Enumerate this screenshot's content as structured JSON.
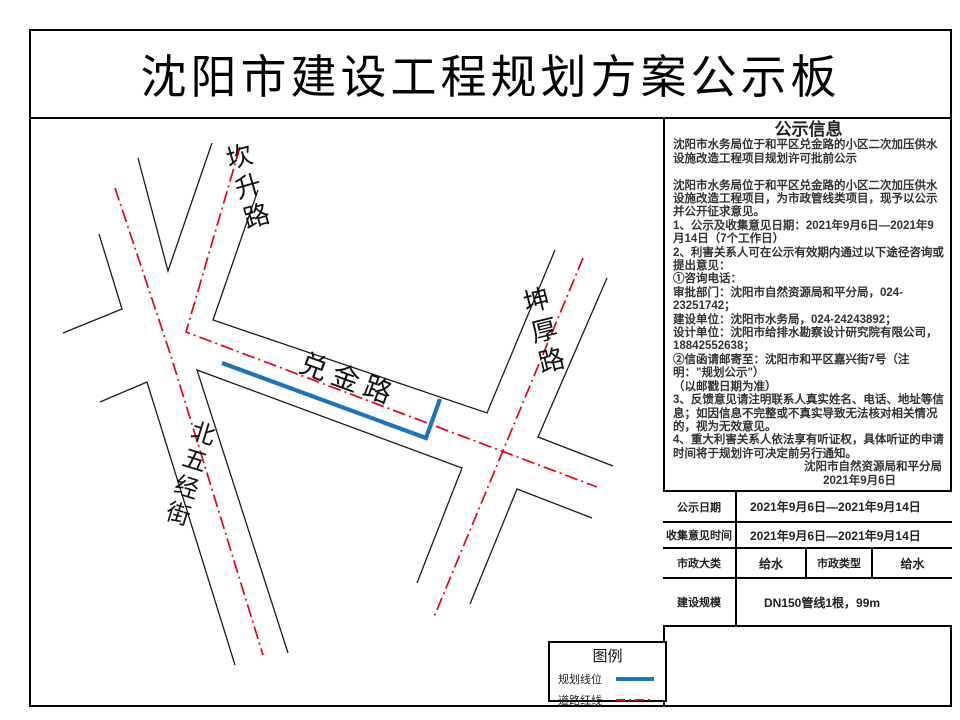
{
  "page_title": "沈阳市建设工程规划方案公示板",
  "map": {
    "road_labels": [
      {
        "name": "坎升路"
      },
      {
        "name": "坤厚路"
      },
      {
        "name": "兑金路"
      },
      {
        "name": "北五经街"
      }
    ]
  },
  "legend": {
    "title": "图例",
    "items": [
      {
        "label": "规划线位"
      },
      {
        "label": "道路红线"
      }
    ]
  },
  "info": {
    "title": "公示信息",
    "paragraphs": [
      "沈阳市水务局位于和平区兑金路的小区二次加压供水设施改造工程项目规划许可批前公示",
      "",
      "沈阳市水务局位于和平区兑金路的小区二次加压供水设施改造工程项目，为市政管线类项目，现予以公示并公开征求意见。",
      "1、公示及收集意见日期：2021年9月6日—2021年9月14日（7个工作日）",
      "2、利害关系人可在公示有效期内通过以下途径咨询或提出意见：",
      "①咨询电话：",
      "审批部门：沈阳市自然资源局和平分局，024-23251742；",
      "建设单位：沈阳市水务局，024-24243892；",
      "设计单位：沈阳市给排水勘察设计研究院有限公司，18842552638；",
      "②信函请邮寄至：沈阳市和平区嘉兴街7号（注明：\"规划公示\"）",
      "（以邮戳日期为准）",
      "3、反馈意见请注明联系人真实姓名、电话、地址等信息；如因信息不完整或不真实导致无法核对相关情况的，视为无效意见。",
      "4、重大利害关系人依法享有听证权，具体听证的申请时间将于规划许可决定前另行通知。"
    ],
    "signature": "沈阳市自然资源局和平分局",
    "signature_date": "2021年9月6日"
  },
  "table": {
    "row1": {
      "label": "公示日期",
      "value": "2021年9月6日—2021年9月14日"
    },
    "row2": {
      "label": "收集意见时间",
      "value": "2021年9月6日—2021年9月14日"
    },
    "row3": {
      "label": "市政大类",
      "value": "给水",
      "label2": "市政类型",
      "value2": "给水"
    },
    "row4": {
      "label": "建设规模",
      "value": "DN150管线1根，99m"
    }
  },
  "colors": {
    "planning_line_blue": "#1f74b8",
    "road_red_line": "#e60012",
    "road_edge_black": "#1a1a1a"
  }
}
